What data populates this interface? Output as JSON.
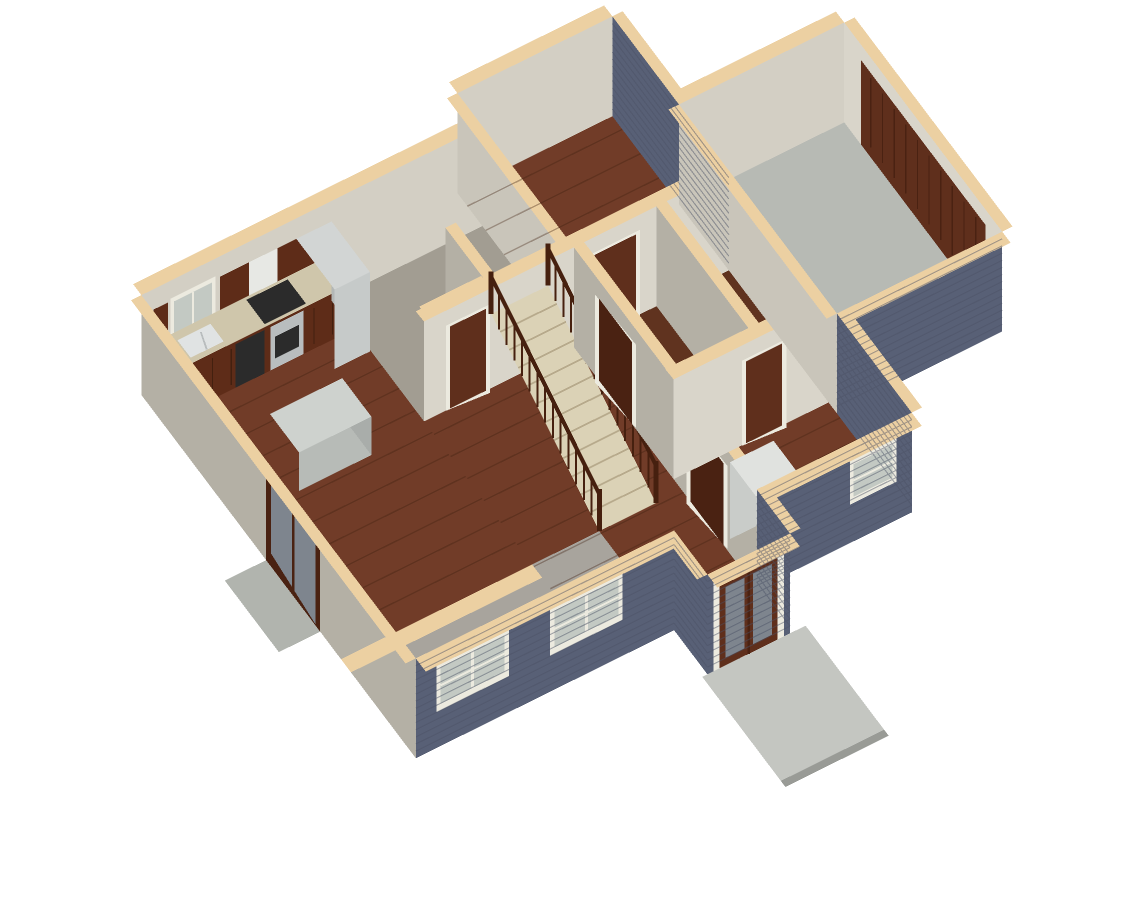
{
  "scene": {
    "type": "3d-floorplan-dollhouse-render",
    "description": "Overhead dollhouse cutaway rendering of a single-story house: kitchen with dark cabinets upper-left, center hallway with wood-railed staircase, carpeted room and bedroom along the back, bathroom and closets center-right, laundry with cabinets front-right, attached garage with concrete floor on the right, gray-carpet living room front-left, front entry double door with concrete porch slab, sliding glass door with side patio on the left",
    "background": "#ffffff"
  },
  "colors": {
    "bg": "#ffffff",
    "siding": "#586076",
    "sidingLine": "#4b5266",
    "cap": "#ecd0a2",
    "capEdge": "#f8ecd3",
    "wallLit": "#d9d5ca",
    "wallMid": "#c9c5ba",
    "wallShadow": "#b4b0a5",
    "wallBack": "#d3cfc4",
    "wood": "#713c28",
    "woodDark": "#60331f",
    "plankLine": "#40200f",
    "carpetGray": "#a8a49d",
    "carpetTaupe": "#a29d92",
    "concreteGarage": "#b7bab4",
    "concretePorch": "#c4c6c1",
    "concretePatio": "#b1b4ae",
    "concreteEdge": "#999b96",
    "cabinet": "#5e2c18",
    "cabinetDark": "#43200f",
    "granite": "#cfc6ab",
    "steel": "#b9bdbe",
    "applianceBlack": "#2b2b2b",
    "hood": "#e7e8e4",
    "sinkSteel": "#e0e3e3",
    "fridgeFront": "#c6cac9",
    "fridgeSide": "#b3b7b6",
    "fridgeTop": "#d2d5d4",
    "whiteCabFront": "#c9ccc9",
    "whiteCabSide": "#d8dbd8",
    "whiteCabTop": "#e0e2df",
    "islandTop": "#ced2ce",
    "islandFront": "#b7bbb7",
    "islandSide": "#a9adaa",
    "stairTread": "#dbd2b6",
    "treadLine": "#b7aa8c",
    "railWood": "#46200f",
    "door": "#5f2f1c",
    "doorDark": "#4a2212",
    "trim": "#eceadf",
    "windowGlass": "#c3c9c3",
    "glassDark": "#7e858e"
  },
  "rooms": [
    {
      "id": "kitchen-dining",
      "floor": "hardwood"
    },
    {
      "id": "living-room",
      "floor": "gray-carpet"
    },
    {
      "id": "back-left-room",
      "floor": "taupe-carpet"
    },
    {
      "id": "hallway",
      "floor": "hardwood"
    },
    {
      "id": "bedroom",
      "floor": "hardwood"
    },
    {
      "id": "bathroom-closets",
      "floor": "hardwood"
    },
    {
      "id": "laundry",
      "floor": "hardwood"
    },
    {
      "id": "entry",
      "floor": "hardwood"
    },
    {
      "id": "garage",
      "floor": "concrete"
    }
  ],
  "objects": [
    "kitchen-upper-cabinets",
    "kitchen-base-cabinets",
    "granite-countertop",
    "kitchen-sink",
    "window-over-sink",
    "range",
    "cooktop",
    "range-hood",
    "dishwasher",
    "refrigerator",
    "kitchen-island",
    "pantry-closet",
    "staircase",
    "stair-railings",
    "interior-doors",
    "garage-door",
    "sliding-glass-door",
    "front-double-door",
    "front-double-windows",
    "laundry-window",
    "utility-cabinet",
    "laundry-cabinets",
    "front-porch-slab",
    "side-patio-slab"
  ]
}
